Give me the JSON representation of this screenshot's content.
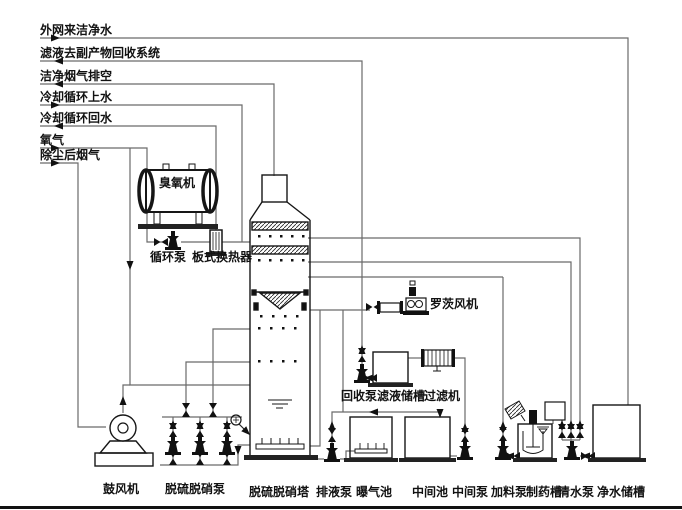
{
  "diagram": {
    "title": "脱硫脱硝系统工艺流程图",
    "colors": {
      "pipe": "#6a6a6a",
      "equipment": "#161616",
      "background": "#ffffff"
    },
    "streams": [
      {
        "text": "外网来洁净水"
      },
      {
        "text": "滤液去副产物回收系统"
      },
      {
        "text": "洁净烟气排空"
      },
      {
        "text": "冷却循环上水"
      },
      {
        "text": "冷却循环回水"
      },
      {
        "text": "氧气"
      },
      {
        "text": "除尘后烟气"
      }
    ],
    "equipment": {
      "ozone": "臭氧机",
      "circ_pump": "循环泵",
      "heat_exchanger": "板式换热器",
      "roots_blower": "罗茨风机",
      "recovery_pump": "回收泵",
      "filtrate_tank": "滤液储槽",
      "filter": "过滤机",
      "blower": "鼓风机",
      "desulf_pumps": "脱硫脱硝泵",
      "tower": "脱硫脱硝塔",
      "drain_pump": "排液泵",
      "aeration_tank": "曝气池",
      "mid_pool": "中间池",
      "mid_pump": "中间泵",
      "feed_pump": "加料泵",
      "med_tank": "制药槽",
      "clean_pump": "清水泵",
      "clean_tank": "净水储槽"
    }
  }
}
